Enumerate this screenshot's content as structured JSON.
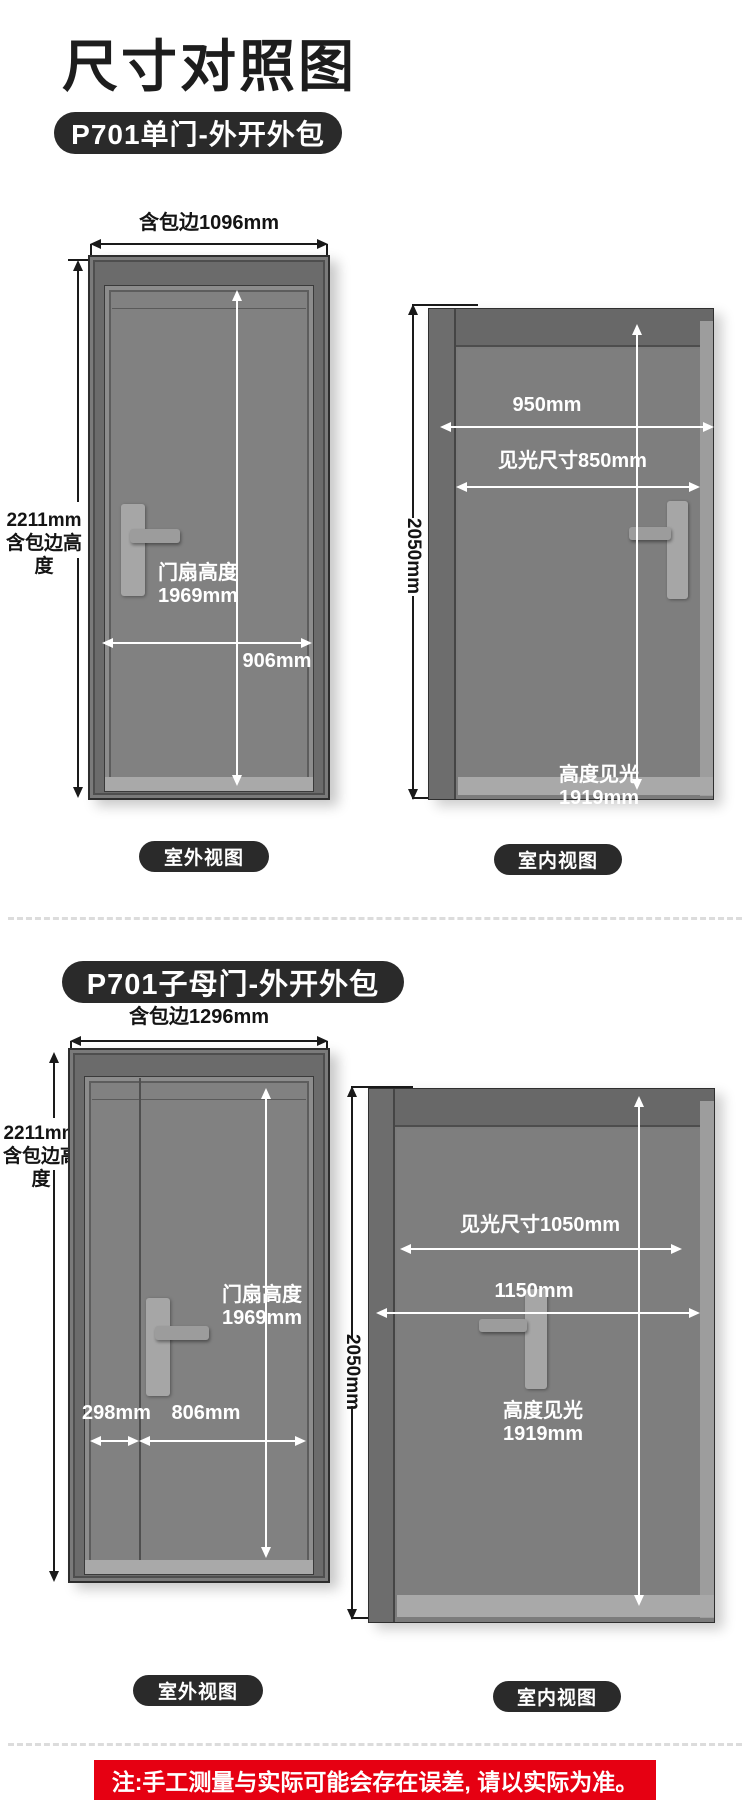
{
  "page": {
    "title": "尺寸对照图",
    "note": "注:手工测量与实际可能会存在误差, 请以实际为准。"
  },
  "colors": {
    "accent_red": "#e60012",
    "badge_black": "#2a2a2a",
    "door_panel_gray": "#818181",
    "door_frame_gray": "#6b6b6b"
  },
  "sections": [
    {
      "badge": "P701单门-外开外包",
      "exterior": {
        "caption": "室外视图",
        "dims": {
          "top": "含包边1096mm",
          "left_line1": "2211mm",
          "left_line2": "含包边高度",
          "leaf_height_line1": "门扇高度",
          "leaf_height_line2": "1969mm",
          "leaf_width": "906mm"
        }
      },
      "interior": {
        "caption": "室内视图",
        "dims": {
          "outer_width": "950mm",
          "clear_width": "见光尺寸850mm",
          "outer_height": "2050mm",
          "clear_height_line1": "高度见光",
          "clear_height_line2": "1919mm"
        }
      }
    },
    {
      "badge": "P701子母门-外开外包",
      "exterior": {
        "caption": "室外视图",
        "dims": {
          "top": "含包边1296mm",
          "left_line1": "2211mm",
          "left_line2": "含包边高度",
          "leaf_height_line1": "门扇高度",
          "leaf_height_line2": "1969mm",
          "child_width": "298mm",
          "mother_width": "806mm"
        }
      },
      "interior": {
        "caption": "室内视图",
        "dims": {
          "clear_width": "见光尺寸1050mm",
          "outer_width": "1150mm",
          "outer_height": "2050mm",
          "clear_height_line1": "高度见光",
          "clear_height_line2": "1919mm"
        }
      }
    }
  ]
}
